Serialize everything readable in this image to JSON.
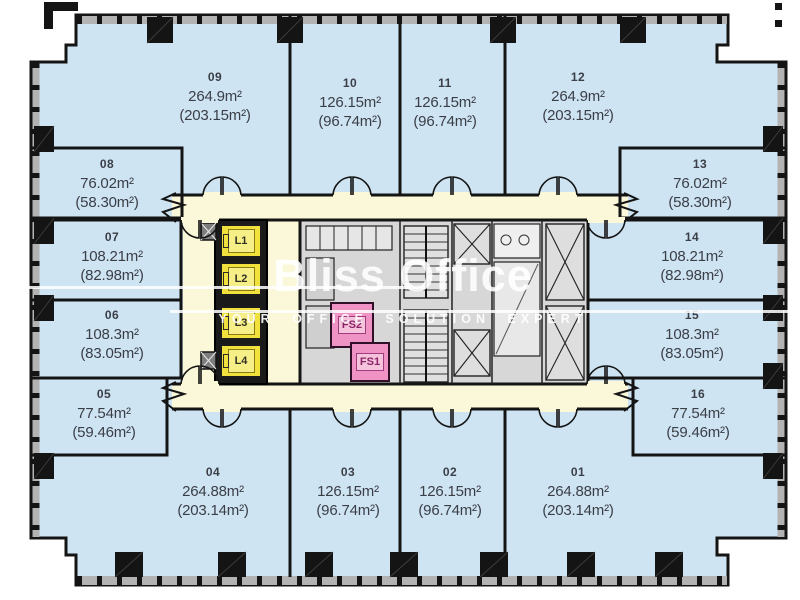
{
  "plan": {
    "watermark": {
      "title": "Bliss Office",
      "subtitle": "YOUR OFFICE SOLUTION EXPERT"
    },
    "units": [
      {
        "id": "09",
        "gross": "264.9m²",
        "net": "(203.15m²)"
      },
      {
        "id": "10",
        "gross": "126.15m²",
        "net": "(96.74m²)"
      },
      {
        "id": "11",
        "gross": "126.15m²",
        "net": "(96.74m²)"
      },
      {
        "id": "12",
        "gross": "264.9m²",
        "net": "(203.15m²)"
      },
      {
        "id": "08",
        "gross": "76.02m²",
        "net": "(58.30m²)"
      },
      {
        "id": "13",
        "gross": "76.02m²",
        "net": "(58.30m²)"
      },
      {
        "id": "07",
        "gross": "108.21m²",
        "net": "(82.98m²)"
      },
      {
        "id": "14",
        "gross": "108.21m²",
        "net": "(82.98m²)"
      },
      {
        "id": "06",
        "gross": "108.3m²",
        "net": "(83.05m²)"
      },
      {
        "id": "15",
        "gross": "108.3m²",
        "net": "(83.05m²)"
      },
      {
        "id": "05",
        "gross": "77.54m²",
        "net": "(59.46m²)"
      },
      {
        "id": "16",
        "gross": "77.54m²",
        "net": "(59.46m²)"
      },
      {
        "id": "04",
        "gross": "264.88m²",
        "net": "(203.14m²)"
      },
      {
        "id": "03",
        "gross": "126.15m²",
        "net": "(96.74m²)"
      },
      {
        "id": "02",
        "gross": "126.15m²",
        "net": "(96.74m²)"
      },
      {
        "id": "01",
        "gross": "264.88m²",
        "net": "(203.14m²)"
      }
    ],
    "lifts": [
      "L1",
      "L2",
      "L3",
      "L4"
    ],
    "fire_stairs": [
      "FS2",
      "FS1"
    ],
    "colors": {
      "office": "#cfe4f2",
      "corridor": "#faf8d9",
      "core": "#d7d7d7",
      "wall": "#141414",
      "mullion_band": "#b3b3b3",
      "lift": "#f1e13c",
      "fire_stair": "#ee93c4",
      "label_text": "#3a3e47"
    }
  }
}
